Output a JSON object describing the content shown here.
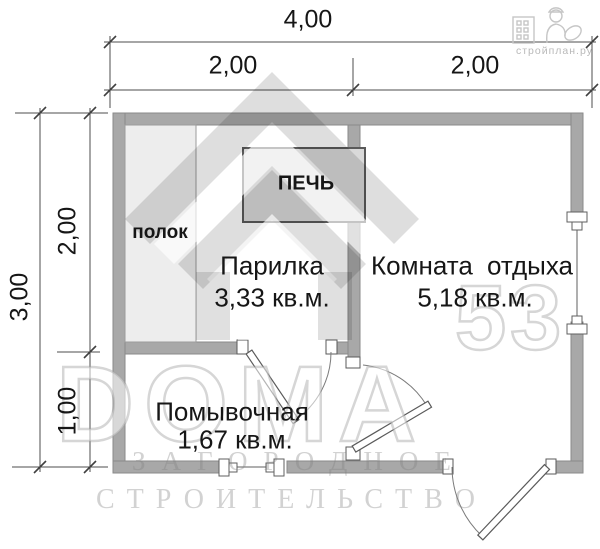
{
  "dimensions": {
    "top_total": "4,00",
    "top_left": "2,00",
    "top_right": "2,00",
    "left_total": "3,00",
    "left_upper": "2,00",
    "left_lower": "1,00"
  },
  "rooms": {
    "steam_room": {
      "name": "Парилка",
      "area": "3,33 кв.м."
    },
    "rest_room": {
      "name": "Комната отдыха",
      "area": "5,18 кв.м."
    },
    "washing_room": {
      "name": "Помывочная",
      "area": "1,67 кв.м."
    },
    "bench_label": "полок",
    "stove_label": "ПЕЧЬ"
  },
  "watermark": {
    "brand": "DOMA",
    "brand_number": "53",
    "tagline_line1": "ЗАГОРОДНОЕ",
    "tagline_line2": "СТРОИТЕЛЬСТВО",
    "site": "стройплан.ру"
  },
  "colors": {
    "wall_fill": "#a8a8a8",
    "wall_stroke": "#8a8a8a",
    "stove_fill": "#d9d9d9",
    "bench_fill": "#ededed",
    "line": "#4c4c4c",
    "watermark_gray": "#d2d2d2"
  }
}
